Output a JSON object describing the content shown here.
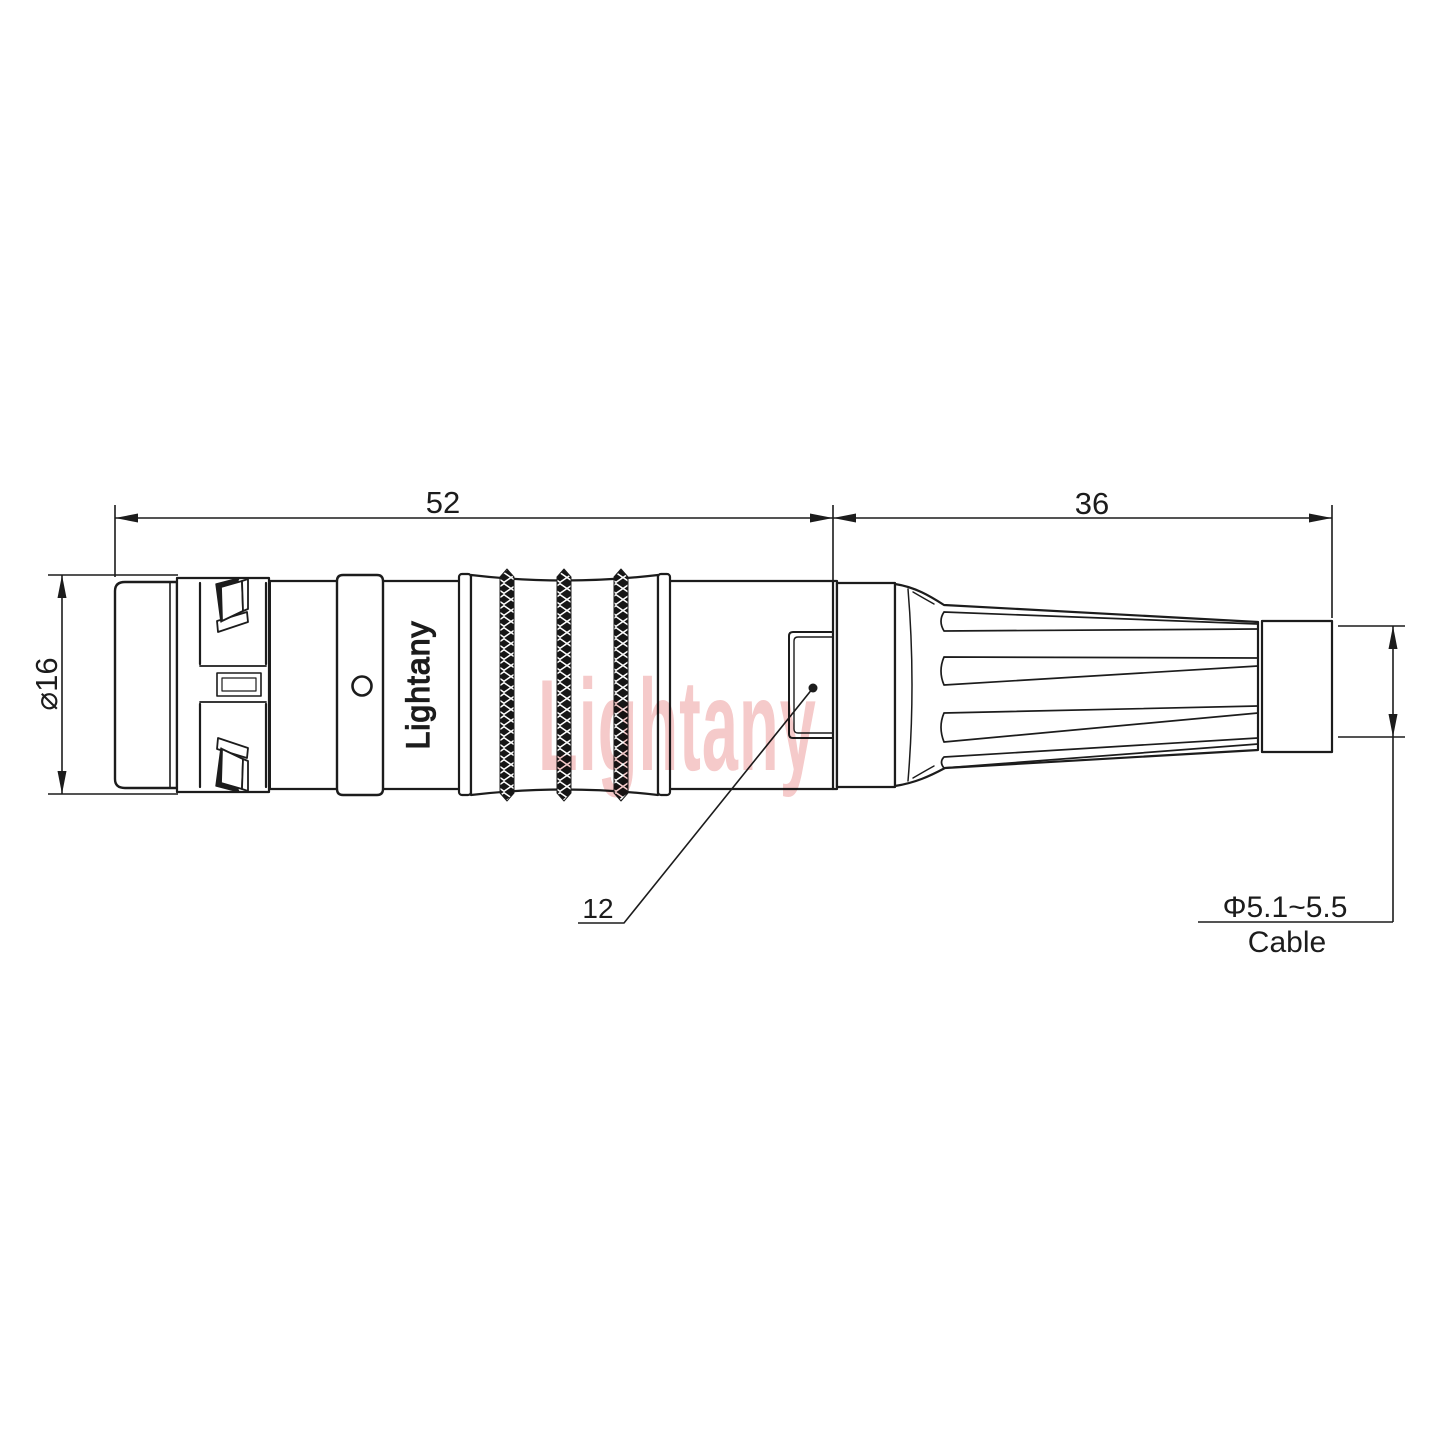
{
  "drawing": {
    "brand": "Lightany",
    "watermark": "Lightany",
    "type_note": "technical drawing of circular push-pull cable connector, side view"
  },
  "dimensions": {
    "overall_length": "52",
    "rear_length": "36",
    "outer_diameter": "⌀16",
    "key_width": "12",
    "cable_diameter": "Φ5.1~5.5",
    "cable_label": "Cable"
  },
  "colors": {
    "line": "#1c1c1c",
    "fill": "#ffffff",
    "watermark": "#f5caca",
    "knurl": "#161616"
  }
}
